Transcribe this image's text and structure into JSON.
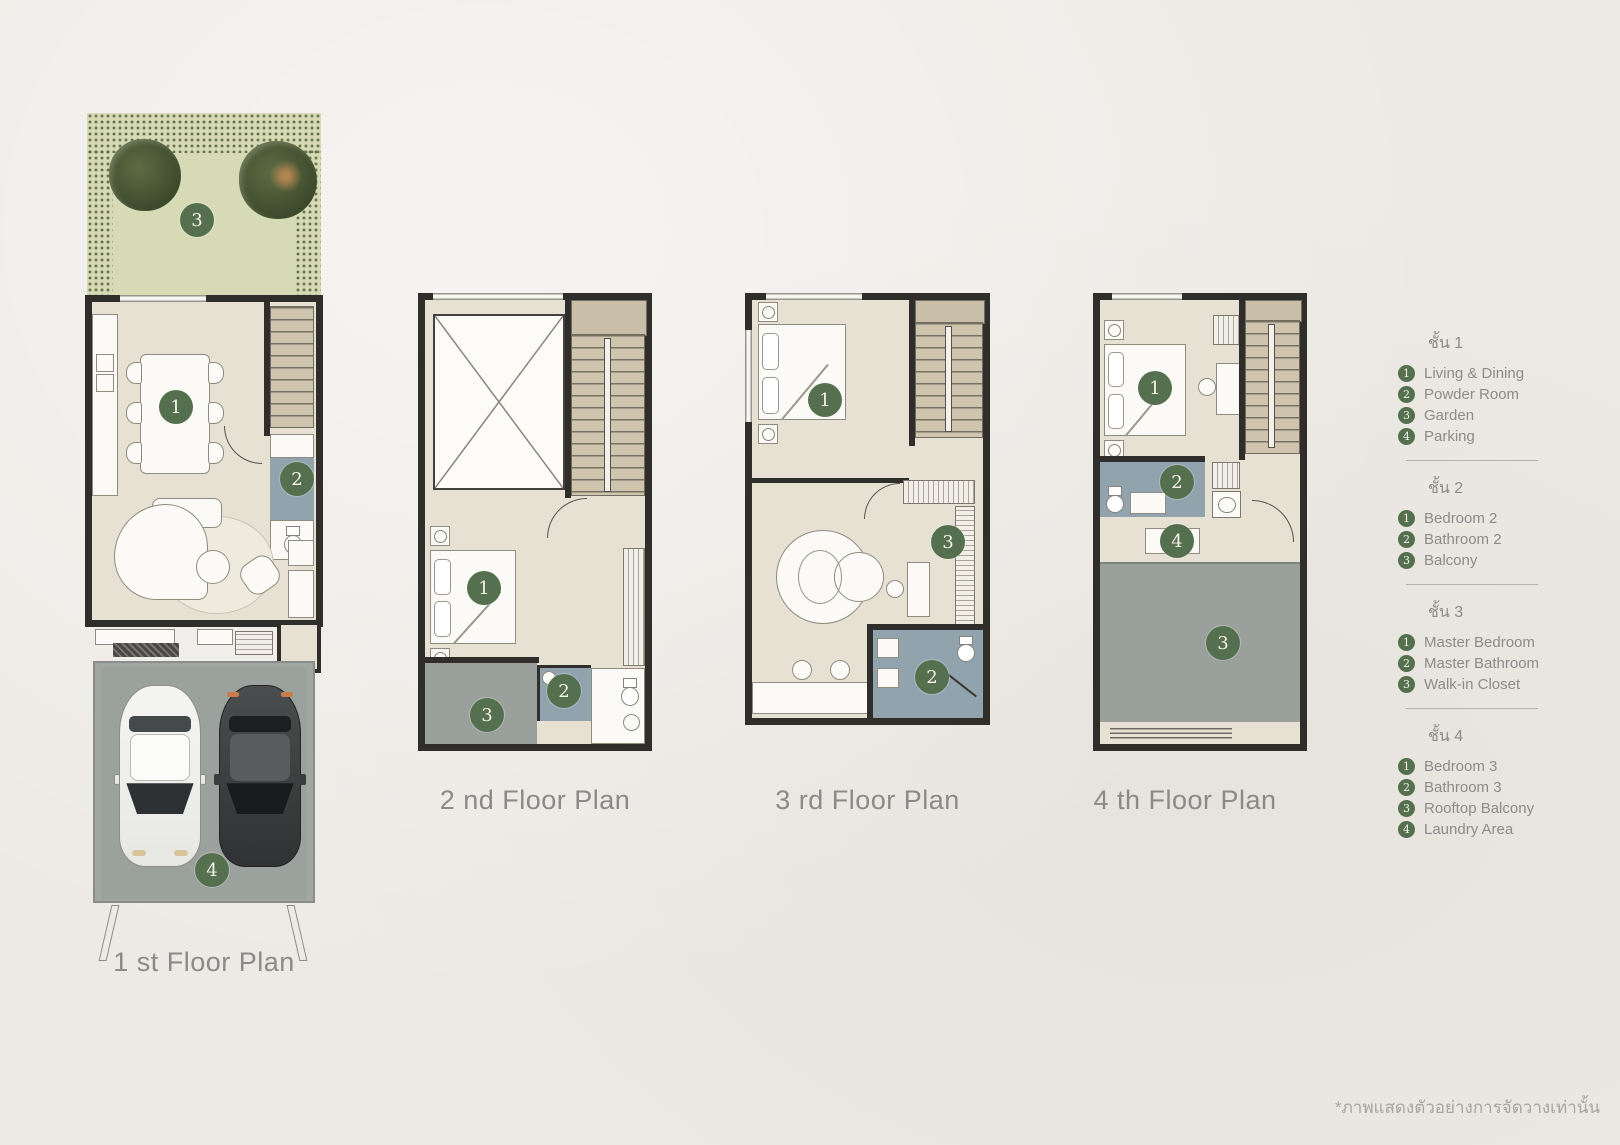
{
  "colors": {
    "background": "#edeae5",
    "wall": "#2f2e2b",
    "floor_beige": "#e7e1d4",
    "garden_green": "#d6dab5",
    "foliage_green": "#44532f",
    "concrete_gray": "#a1a6a2",
    "bathroom_blue": "#91a4ad",
    "stair_tan": "#cfc5ae",
    "badge_green": "#55704e",
    "label_gray": "#8a8a88"
  },
  "plans": [
    {
      "label": "1 st Floor Plan",
      "badges": [
        {
          "number": "1",
          "room": "Living & Dining"
        },
        {
          "number": "2",
          "room": "Powder Room"
        },
        {
          "number": "3",
          "room": "Garden"
        },
        {
          "number": "4",
          "room": "Parking"
        }
      ]
    },
    {
      "label": "2 nd Floor Plan",
      "badges": [
        {
          "number": "1",
          "room": "Bedroom 2"
        },
        {
          "number": "2",
          "room": "Bathroom 2"
        },
        {
          "number": "3",
          "room": "Balcony"
        }
      ]
    },
    {
      "label": "3 rd Floor Plan",
      "badges": [
        {
          "number": "1",
          "room": "Master Bedroom"
        },
        {
          "number": "2",
          "room": "Master Bathroom"
        },
        {
          "number": "3",
          "room": "Walk-in Closet"
        }
      ]
    },
    {
      "label": "4 th Floor Plan",
      "badges": [
        {
          "number": "1",
          "room": "Bedroom 3"
        },
        {
          "number": "2",
          "room": "Bathroom 3"
        },
        {
          "number": "3",
          "room": "Rooftop Balcony"
        },
        {
          "number": "4",
          "room": "Laundry Area"
        }
      ]
    }
  ],
  "legend": {
    "sections": [
      {
        "title": "ชั้น 1",
        "items": [
          {
            "number": "1",
            "label": "Living & Dining"
          },
          {
            "number": "2",
            "label": "Powder Room"
          },
          {
            "number": "3",
            "label": "Garden"
          },
          {
            "number": "4",
            "label": "Parking"
          }
        ]
      },
      {
        "title": "ชั้น 2",
        "items": [
          {
            "number": "1",
            "label": "Bedroom 2"
          },
          {
            "number": "2",
            "label": "Bathroom 2"
          },
          {
            "number": "3",
            "label": "Balcony"
          }
        ]
      },
      {
        "title": "ชั้น 3",
        "items": [
          {
            "number": "1",
            "label": "Master Bedroom"
          },
          {
            "number": "2",
            "label": "Master Bathroom"
          },
          {
            "number": "3",
            "label": "Walk-in Closet"
          }
        ]
      },
      {
        "title": "ชั้น 4",
        "items": [
          {
            "number": "1",
            "label": "Bedroom 3"
          },
          {
            "number": "2",
            "label": "Bathroom 3"
          },
          {
            "number": "3",
            "label": "Rooftop Balcony"
          },
          {
            "number": "4",
            "label": "Laundry Area"
          }
        ]
      }
    ]
  },
  "footnote": "*ภาพแสดงตัวอย่างการจัดวางเท่านั้น"
}
